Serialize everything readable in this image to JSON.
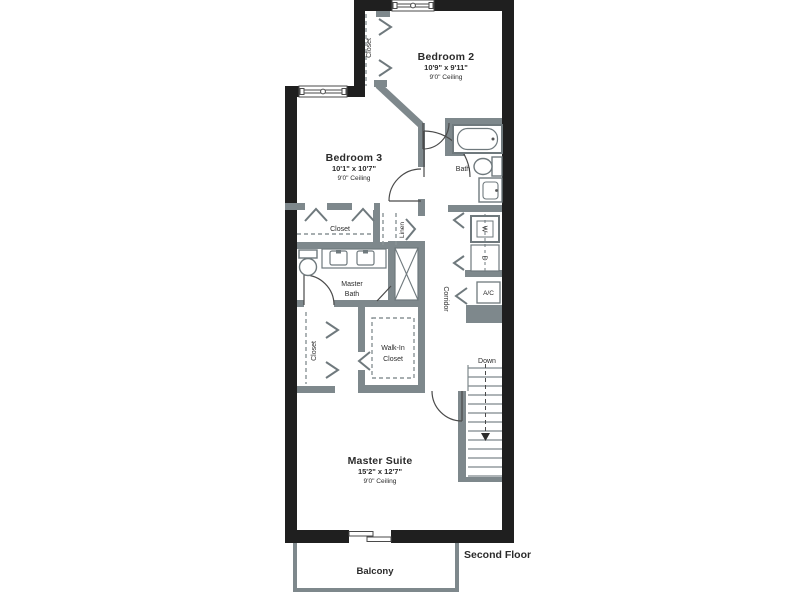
{
  "meta": {
    "floor_label": "Second Floor"
  },
  "colors": {
    "exterior_wall": "#1f1f1f",
    "interior_wall": "#7e888c",
    "text": "#2b2b2b",
    "background": "#ffffff"
  },
  "rooms": {
    "bedroom2": {
      "name": "Bedroom 2",
      "dims": "10'9\" x 9'11\"",
      "ceiling": "9'0\" Ceiling"
    },
    "bedroom3": {
      "name": "Bedroom 3",
      "dims": "10'1\" x 10'7\"",
      "ceiling": "9'0\" Ceiling"
    },
    "master_suite": {
      "name": "Master Suite",
      "dims": "15'2\" x 12'7\"",
      "ceiling": "9'0\" Ceiling"
    },
    "bath": {
      "name": "Bath"
    },
    "master_bath": {
      "line1": "Master",
      "line2": "Bath"
    },
    "walk_in_closet": {
      "line1": "Walk-In",
      "line2": "Closet"
    },
    "bedroom2_closet": {
      "name": "Closet"
    },
    "bedroom3_closet": {
      "name": "Closet"
    },
    "master_closet": {
      "name": "Closet"
    },
    "linen": {
      "name": "Linen"
    },
    "corridor": {
      "name": "Corridor"
    },
    "balcony": {
      "name": "Balcony"
    }
  },
  "labels": {
    "ac": "A/C",
    "washer": "W",
    "dryer": "D",
    "stairs_down": "Down"
  }
}
